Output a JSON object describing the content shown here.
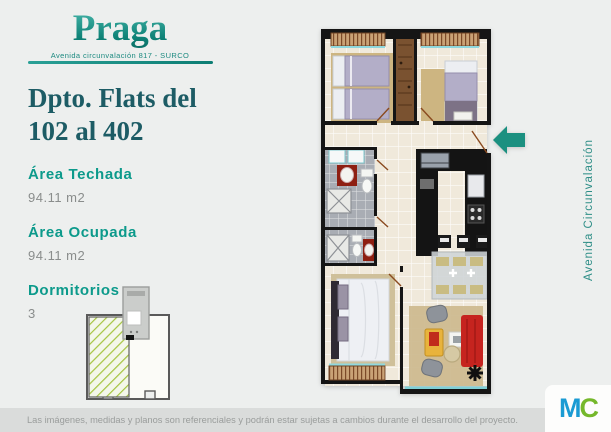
{
  "brand": {
    "title": "Praga",
    "subtitle": "Avenida circunvalación 817 - SURCO"
  },
  "unit": {
    "heading": "Dpto. Flats del 102 al 402"
  },
  "specs": [
    {
      "label": "Área Techada",
      "value": "94.11 m2"
    },
    {
      "label": "Área Ocupada",
      "value": "94.11 m2"
    },
    {
      "label": "Dormitorios",
      "value": "3"
    }
  ],
  "street_label": "Avenida Circunvalación",
  "footer": {
    "disclaimer": "Las imágenes, medidas y planos son referenciales y podrán estar sujetas a cambios durante el desarrollo del proyecto.",
    "logo_m": "M",
    "logo_c": "C"
  },
  "icons": {
    "entry_arrow": "arrow-left-icon"
  },
  "colors": {
    "background": "#edefee",
    "accent_teal": "#14968b",
    "heading_teal": "#1d5c65",
    "arrow_teal": "#1b9080",
    "footer_bar": "#dadcdb",
    "logo_blue": "#1b9bd3",
    "logo_green": "#75b82b",
    "hatch_green": "#a5c440",
    "sofa_red": "#c6241f",
    "floor_cream": "#f0e9db",
    "bath_gray": "#a9adb4",
    "wall_black": "#151515"
  }
}
